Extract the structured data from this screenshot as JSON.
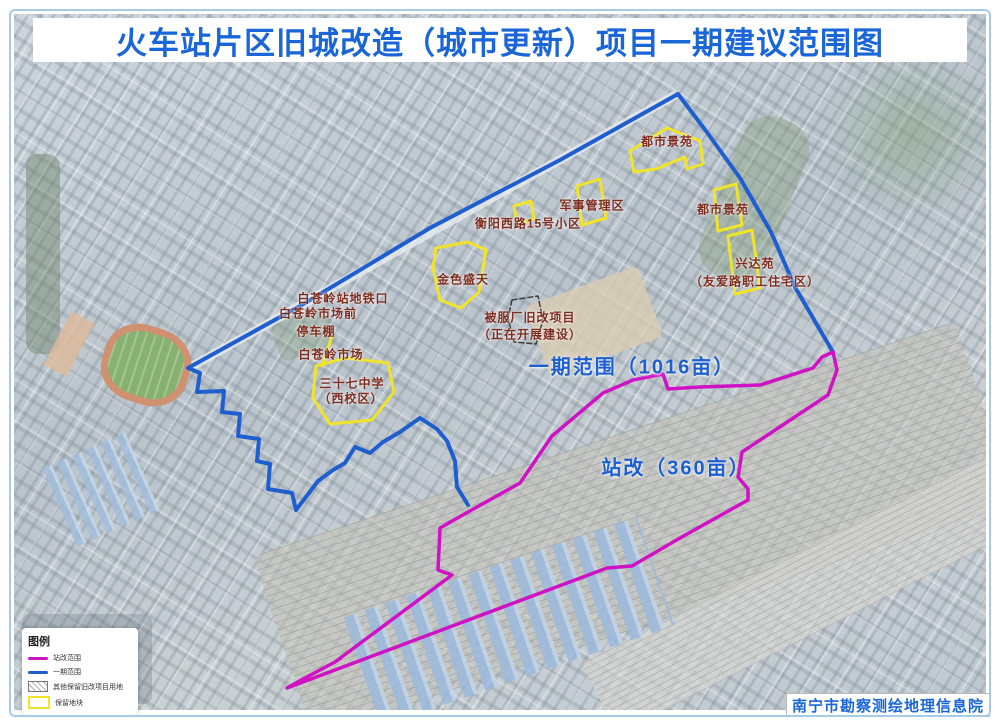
{
  "title": "火车站片区旧城改造（城市更新）项目一期建议范围图",
  "credit": "南宁市勘察测绘地理信息院",
  "legend": {
    "title": "图例",
    "items": [
      {
        "label": "站改范围",
        "type": "line",
        "color": "#cf12c4"
      },
      {
        "label": "一期范围",
        "type": "line",
        "color": "#1e5ecf"
      },
      {
        "label": "其他保留旧改项目用地",
        "type": "hatch",
        "color": "#777777"
      },
      {
        "label": "保留地块",
        "type": "box",
        "color": "#f0e32a"
      }
    ]
  },
  "map": {
    "labels": [
      {
        "kind": "area",
        "name": "area-label-phase1",
        "text": "一期范围（1016亩）",
        "x": 632,
        "y": 365
      },
      {
        "kind": "area",
        "name": "area-label-station",
        "text": "站改（360亩）",
        "x": 676,
        "y": 466
      },
      {
        "kind": "site",
        "name": "plot-label-dushijingyuan-1",
        "text": "都市景苑",
        "x": 667,
        "y": 141
      },
      {
        "kind": "site",
        "name": "plot-label-junshi",
        "text": "军事管理区",
        "x": 592,
        "y": 205
      },
      {
        "kind": "site",
        "name": "plot-label-hengyang",
        "text": "衡阳西路15号小区",
        "x": 528,
        "y": 223
      },
      {
        "kind": "site",
        "name": "plot-label-dushijingyuan-2",
        "text": "都市景苑",
        "x": 723,
        "y": 209
      },
      {
        "kind": "site",
        "name": "plot-label-xingdayuan",
        "text": "兴达苑",
        "x": 755,
        "y": 263
      },
      {
        "kind": "site",
        "name": "plot-label-xingdayuan-sub",
        "text": "（友爱路职工住宅区）",
        "x": 755,
        "y": 281
      },
      {
        "kind": "site",
        "name": "plot-label-jinsesheng",
        "text": "金色盛天",
        "x": 463,
        "y": 279
      },
      {
        "kind": "site",
        "name": "plot-label-beifuchang",
        "text": "被服厂旧改项目",
        "x": 530,
        "y": 317
      },
      {
        "kind": "site",
        "name": "plot-label-beifuchang-sub",
        "text": "（正在开展建设）",
        "x": 530,
        "y": 334
      },
      {
        "kind": "site",
        "name": "plot-label-metro",
        "text": "白苍岭站地铁口",
        "x": 343,
        "y": 298
      },
      {
        "kind": "site",
        "name": "plot-label-market-front",
        "text": "白苍岭市场前",
        "x": 318,
        "y": 313
      },
      {
        "kind": "site",
        "name": "plot-label-carport",
        "text": "停车棚",
        "x": 316,
        "y": 331
      },
      {
        "kind": "site",
        "name": "plot-label-market",
        "text": "白苍岭市场",
        "x": 331,
        "y": 354
      },
      {
        "kind": "site",
        "name": "plot-label-school",
        "text": "三十七中学",
        "x": 352,
        "y": 383
      },
      {
        "kind": "site",
        "name": "plot-label-school-sub",
        "text": "（西校区）",
        "x": 351,
        "y": 398
      }
    ],
    "shapes": [
      {
        "name": "phase1-boundary",
        "type": "polyline",
        "color": "#1e5ecf",
        "width": 4,
        "points": [
          [
            833,
            352
          ],
          [
            820,
            330
          ],
          [
            795,
            287
          ],
          [
            771,
            232
          ],
          [
            740,
            178
          ],
          [
            706,
            131
          ],
          [
            678,
            94
          ],
          [
            560,
            160
          ],
          [
            430,
            228
          ],
          [
            300,
            306
          ],
          [
            188,
            368
          ],
          [
            200,
            373
          ],
          [
            197,
            392
          ],
          [
            224,
            391
          ],
          [
            222,
            412
          ],
          [
            240,
            414
          ],
          [
            238,
            436
          ],
          [
            259,
            439
          ],
          [
            257,
            461
          ],
          [
            270,
            464
          ],
          [
            268,
            489
          ],
          [
            292,
            493
          ],
          [
            296,
            510
          ],
          [
            318,
            481
          ],
          [
            333,
            470
          ],
          [
            345,
            463
          ],
          [
            355,
            447
          ],
          [
            370,
            453
          ],
          [
            383,
            442
          ],
          [
            400,
            432
          ],
          [
            420,
            418
          ],
          [
            437,
            429
          ],
          [
            447,
            441
          ],
          [
            455,
            461
          ],
          [
            457,
            487
          ],
          [
            468,
            505
          ]
        ]
      },
      {
        "name": "station-scope-boundary",
        "type": "polygon",
        "color": "#cf12c4",
        "width": 3.5,
        "points": [
          [
            833,
            352
          ],
          [
            837,
            370
          ],
          [
            828,
            395
          ],
          [
            742,
            452
          ],
          [
            738,
            477
          ],
          [
            748,
            489
          ],
          [
            748,
            500
          ],
          [
            680,
            538
          ],
          [
            632,
            566
          ],
          [
            607,
            568
          ],
          [
            287,
            688
          ],
          [
            303,
            679
          ],
          [
            335,
            662
          ],
          [
            452,
            575
          ],
          [
            438,
            570
          ],
          [
            440,
            528
          ],
          [
            468,
            512
          ],
          [
            520,
            483
          ],
          [
            552,
            436
          ],
          [
            603,
            393
          ],
          [
            633,
            380
          ],
          [
            663,
            374
          ],
          [
            668,
            389
          ],
          [
            700,
            387
          ],
          [
            760,
            385
          ],
          [
            813,
            368
          ],
          [
            822,
            357
          ]
        ]
      },
      {
        "name": "reserved-plot-dushijingyuan-1",
        "type": "polygon",
        "color": "#f0e32a",
        "width": 3,
        "points": [
          [
            630,
            151
          ],
          [
            667,
            128
          ],
          [
            700,
            141
          ],
          [
            703,
            164
          ],
          [
            687,
            169
          ],
          [
            685,
            157
          ],
          [
            656,
            169
          ],
          [
            634,
            172
          ]
        ]
      },
      {
        "name": "reserved-plot-dushijingyuan-2",
        "type": "polygon",
        "color": "#f0e32a",
        "width": 3,
        "points": [
          [
            714,
            190
          ],
          [
            736,
            184
          ],
          [
            742,
            225
          ],
          [
            718,
            231
          ]
        ]
      },
      {
        "name": "reserved-plot-xingdayuan",
        "type": "polygon",
        "color": "#f0e32a",
        "width": 3,
        "points": [
          [
            728,
            236
          ],
          [
            752,
            230
          ],
          [
            760,
            288
          ],
          [
            735,
            294
          ]
        ]
      },
      {
        "name": "reserved-plot-junshi",
        "type": "polygon",
        "color": "#f0e32a",
        "width": 3,
        "points": [
          [
            577,
            186
          ],
          [
            600,
            179
          ],
          [
            606,
            218
          ],
          [
            582,
            225
          ]
        ]
      },
      {
        "name": "reserved-plot-hengyang",
        "type": "polygon",
        "color": "#f0e32a",
        "width": 3,
        "points": [
          [
            514,
            206
          ],
          [
            531,
            201
          ],
          [
            534,
            219
          ],
          [
            517,
            224
          ]
        ]
      },
      {
        "name": "reserved-plot-jinsesheng",
        "type": "polygon",
        "color": "#f0e32a",
        "width": 3,
        "points": [
          [
            436,
            248
          ],
          [
            468,
            242
          ],
          [
            486,
            250
          ],
          [
            479,
            292
          ],
          [
            461,
            308
          ],
          [
            440,
            300
          ],
          [
            433,
            268
          ]
        ]
      },
      {
        "name": "reserved-plot-school",
        "type": "polygon",
        "color": "#f0e32a",
        "width": 3,
        "points": [
          [
            316,
            366
          ],
          [
            345,
            358
          ],
          [
            388,
            363
          ],
          [
            394,
            392
          ],
          [
            372,
            420
          ],
          [
            330,
            424
          ],
          [
            313,
            398
          ]
        ]
      },
      {
        "name": "reserved-plot-school-stem",
        "type": "polyline",
        "color": "#f0e32a",
        "width": 3,
        "points": [
          [
            332,
            336
          ],
          [
            322,
            366
          ]
        ]
      },
      {
        "name": "beifuchang-plot-outline",
        "type": "polygon",
        "color": "#3a3a3a",
        "width": 1.5,
        "dash": "5,3",
        "points": [
          [
            512,
            300
          ],
          [
            538,
            296
          ],
          [
            543,
            320
          ],
          [
            536,
            344
          ],
          [
            514,
            342
          ],
          [
            508,
            318
          ]
        ]
      }
    ]
  }
}
